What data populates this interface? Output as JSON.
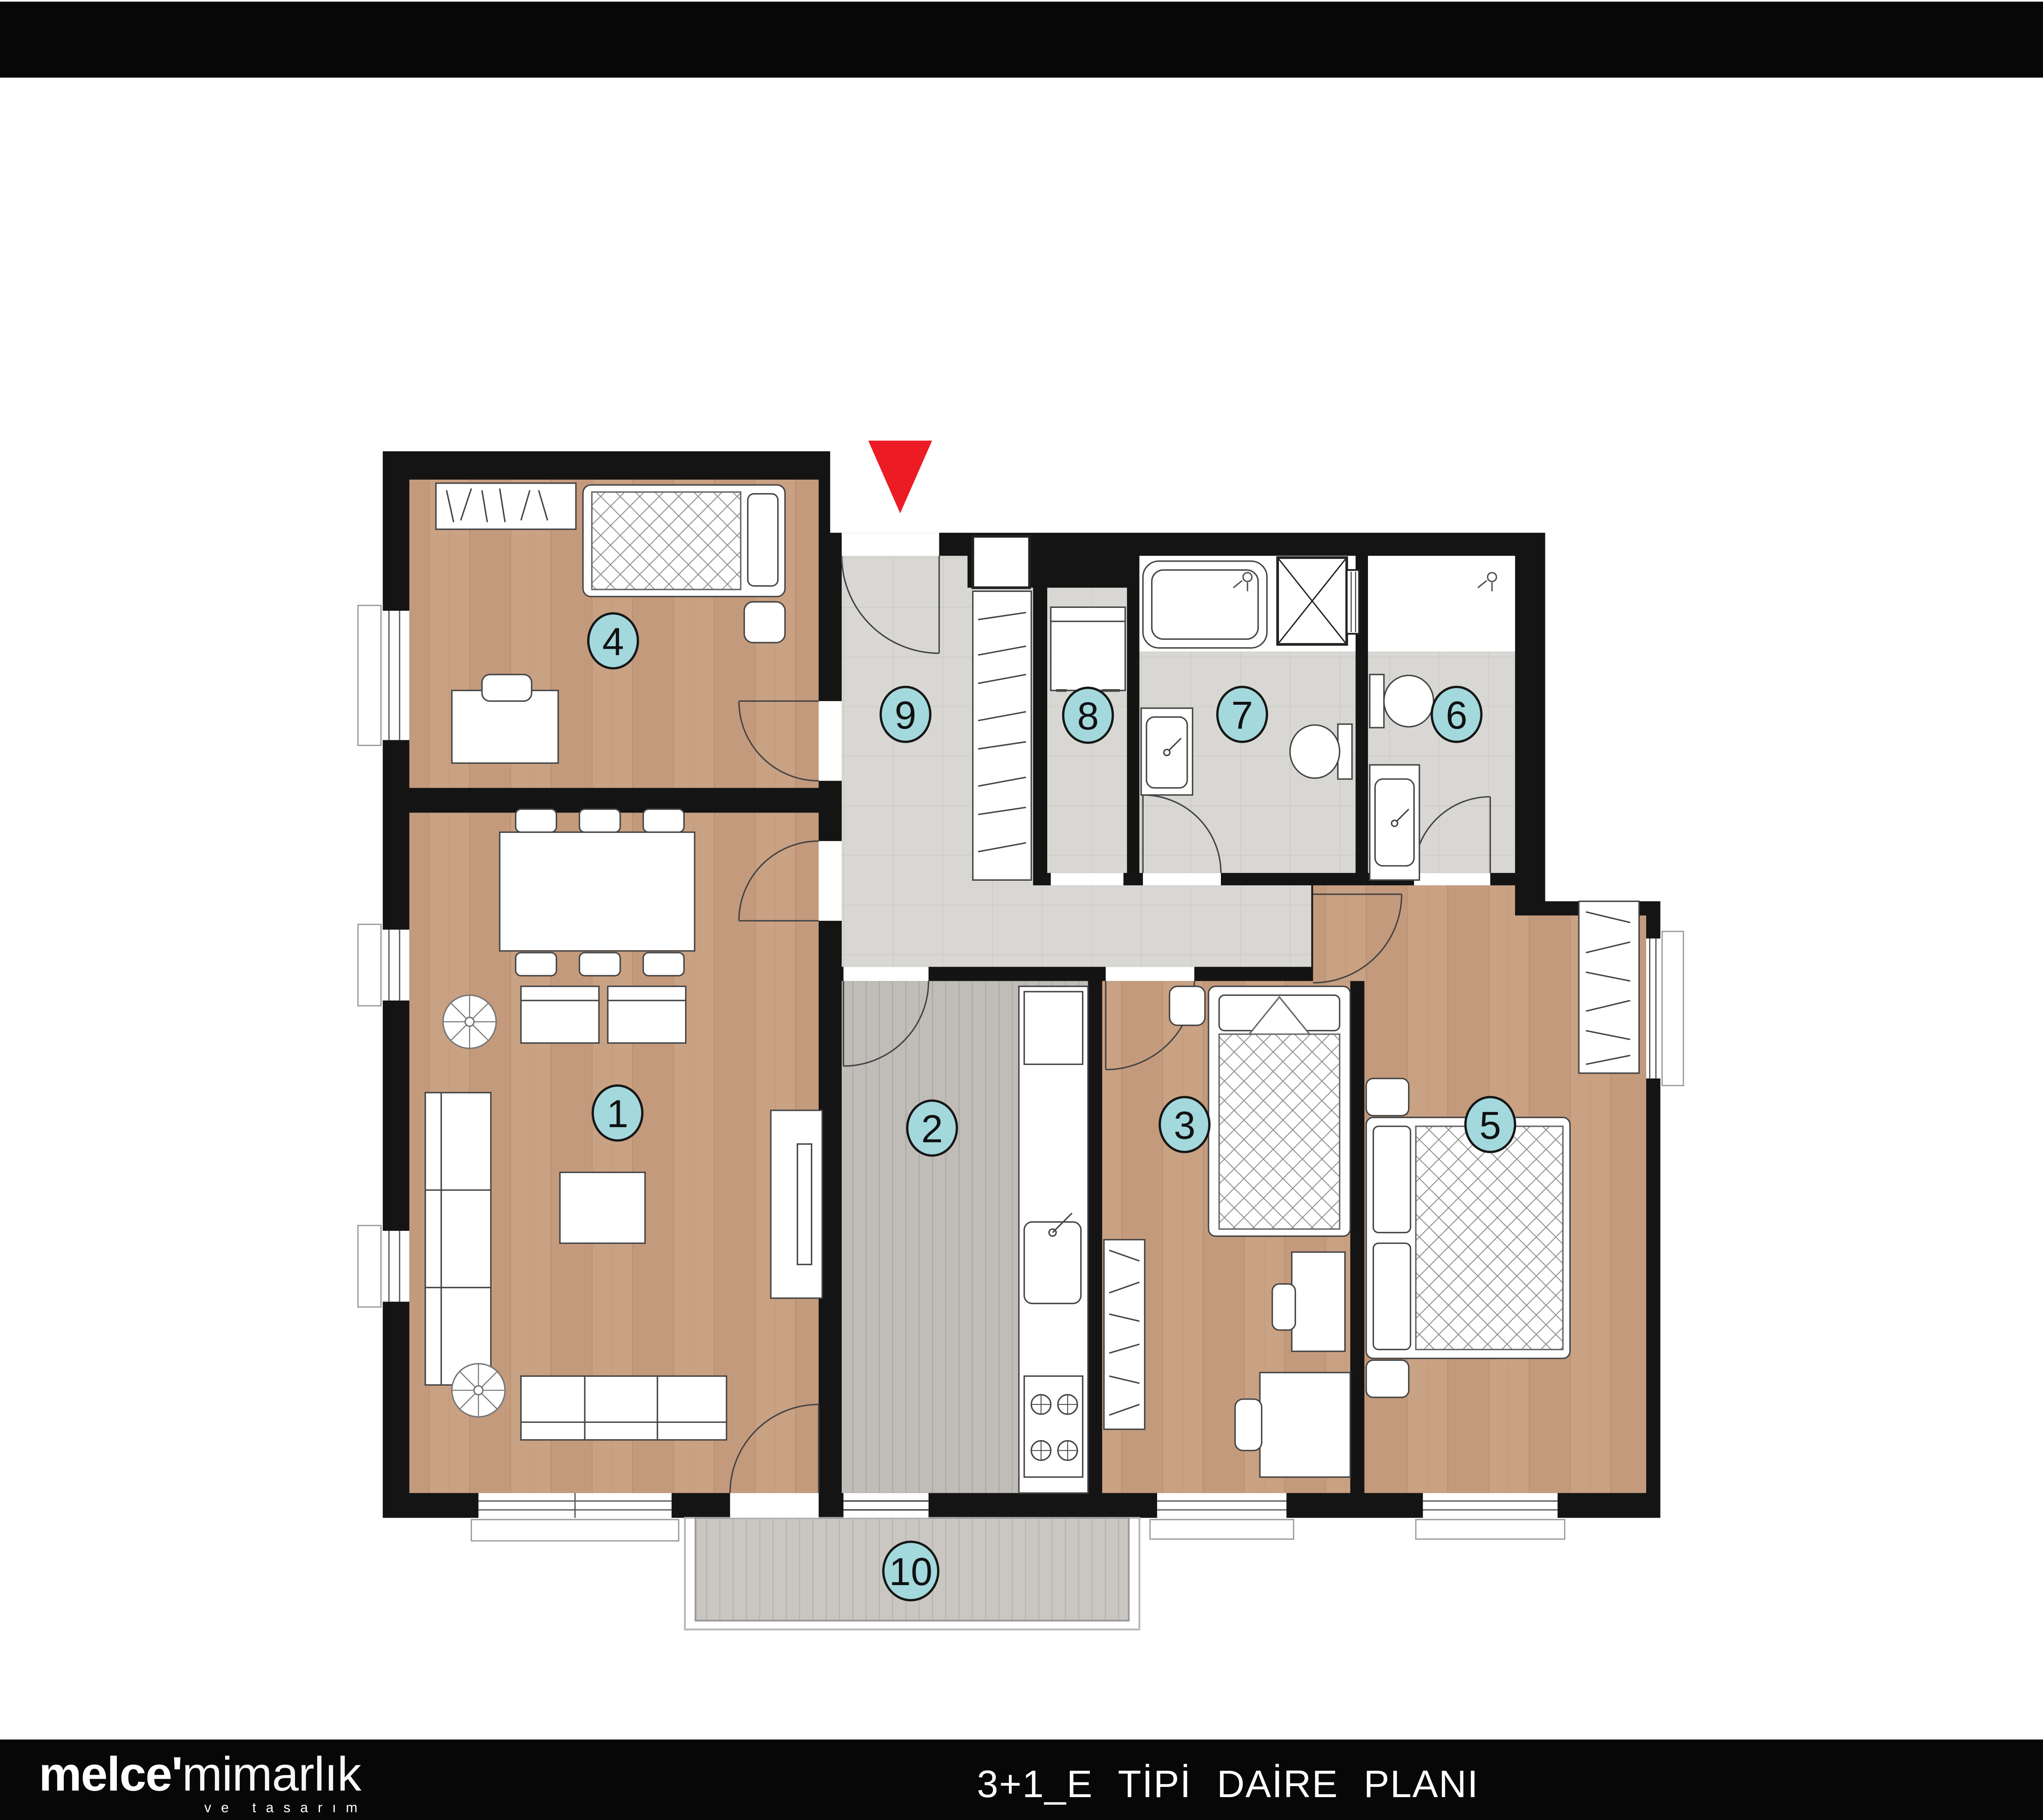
{
  "title_block": {
    "title": "3+1_E TİPİ DAİRE",
    "net_label": "NET",
    "net_value": ":93,55",
    "net_unit": "M2",
    "brut_label": "BRÜT",
    "brut_value": ":122,00",
    "brut_unit": "M2"
  },
  "legend": {
    "items": [
      {
        "num": "1",
        "label": "SALON:",
        "value": "23,20",
        "unit": "M2"
      },
      {
        "num": "2",
        "label": "MUTFAK:",
        "value": "10,40",
        "unit": "M2"
      },
      {
        "num": "3",
        "label": "ODA :",
        "value": "10,30",
        "unit": "M2"
      },
      {
        "num": "4",
        "label": "ODA:",
        "value": "10,05",
        "unit": "M2"
      },
      {
        "num": "5",
        "label": "E.YATAK ODASI:",
        "value": "14,60",
        "unit": "M2"
      },
      {
        "num": "6",
        "label": "E.BANYO:",
        "value": "3,50",
        "unit": "M2"
      },
      {
        "num": "7",
        "label": "BANYO:",
        "value": "3,90",
        "unit": "M2"
      },
      {
        "num": "8",
        "label": "ÇAMAŞIR ODASI:",
        "value": "1,75",
        "unit": "M2"
      },
      {
        "num": "9",
        "label": "ANTRE :",
        "value": "9,50",
        "unit": "M2"
      },
      {
        "num": "10",
        "label": "BALKON:",
        "value": "6,35",
        "unit": "M2"
      }
    ]
  },
  "plan": {
    "rooms": {
      "r1": "1",
      "r2": "2",
      "r3": "3",
      "r4": "4",
      "r5": "5",
      "r6": "6",
      "r7": "7",
      "r8": "8",
      "r9": "9",
      "r10": "10"
    }
  },
  "footer": {
    "logo_bold": "melce'",
    "logo_light": "mimarlık",
    "logo_tagline": "ve tasarım",
    "caption": "3+1_E TİPİ DAİRE PLANI"
  },
  "colors": {
    "wall_black": "#141414",
    "room_circle_teal": "#a3d8dc",
    "legend_circle_teal": "#bce8ec",
    "entrance_arrow_red": "#ed1c24",
    "wood_floor": "#c9a183",
    "tile_gray": "#d8d7d3",
    "kitchen_plank": "#c0bcb7",
    "balcony_plank": "#cac6c1",
    "site_unit_highlight": "#cfbca0"
  }
}
